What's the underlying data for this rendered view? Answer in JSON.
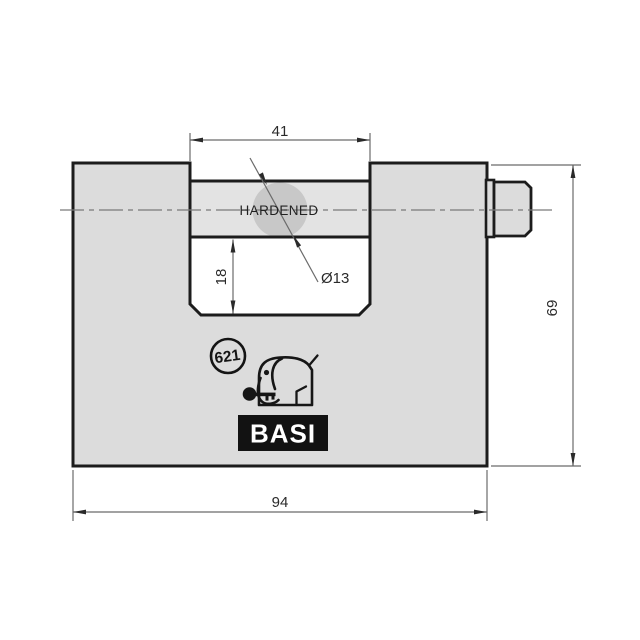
{
  "drawing": {
    "dimensions": {
      "shackle_opening_width": "41",
      "slot_depth": "18",
      "pin_diameter": "Ø13",
      "body_width": "94",
      "body_height": "69"
    },
    "labels": {
      "hardened": "HARDENED",
      "model_number": "621",
      "brand": "BASI"
    },
    "colors": {
      "body_fill": "#dcdcdc",
      "shackle_fill": "#e3e3e3",
      "pin_fill": "#c8c8c8",
      "outline": "#1c1c1c",
      "dimension_line": "#6b6b6b",
      "center_line": "#7a7a7a",
      "logo_box_fill": "#121212",
      "logo_text": "#ffffff"
    }
  }
}
